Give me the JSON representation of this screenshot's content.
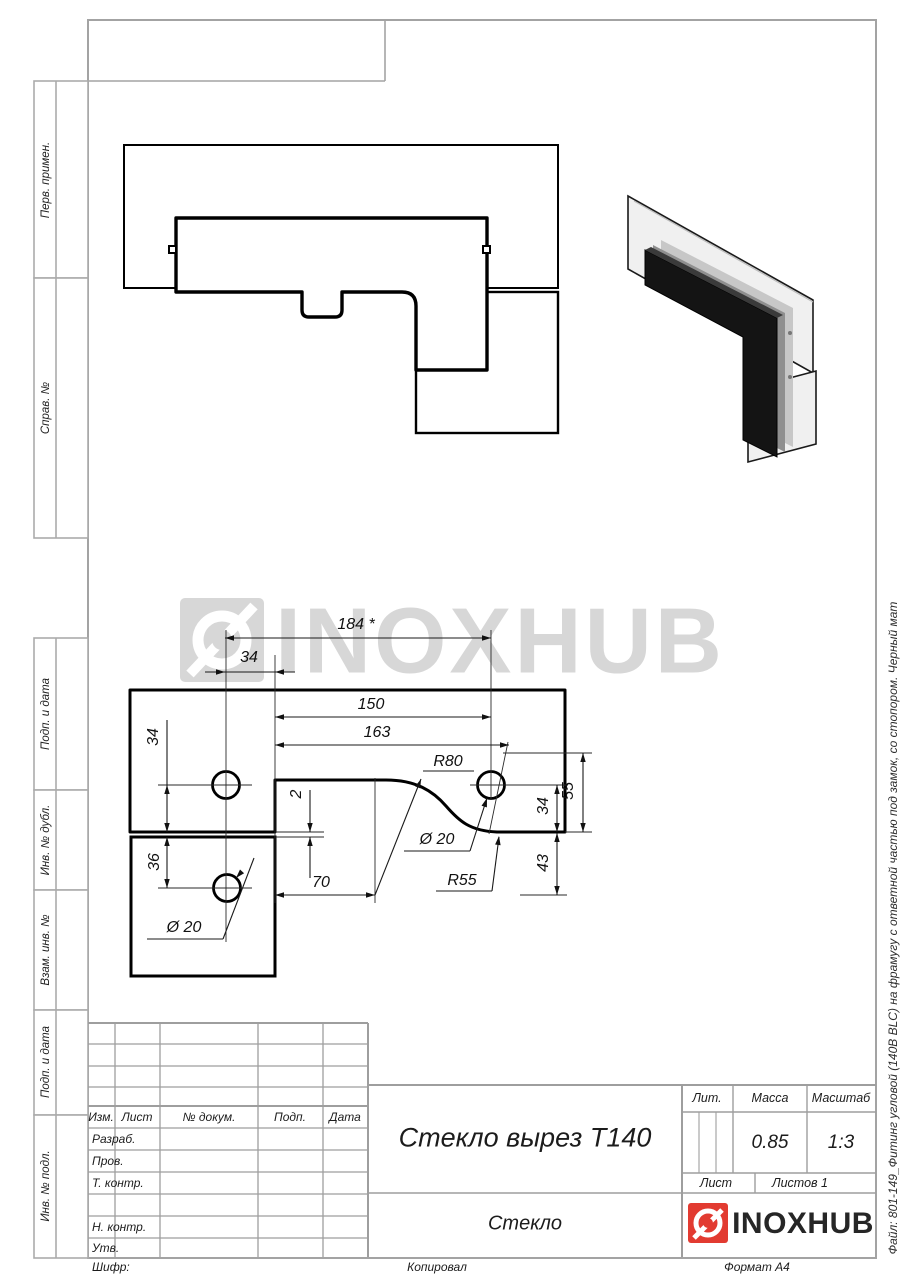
{
  "sheet": {
    "watermark_text": "INOXHUB",
    "file_note": "Файл: 801-149_Фитинг угловой (140В BLC) на фрамугу с ответной частью под замок, со стопором. Черный мат",
    "cipher_label": "Шифр:",
    "copied_note": "Копировал",
    "format_note": "Формат А4"
  },
  "margin_labels": {
    "perv": "Перв. примен.",
    "sprav": "Справ. №",
    "podp1": "Подп. и дата",
    "inv_dubl": "Инв. № дубл.",
    "vzam": "Взам. инв. №",
    "podp2": "Подп. и дата",
    "inv_podl": "Инв. № подл."
  },
  "title_block": {
    "doc_title": "Стекло вырез Т140",
    "part_name": "Стекло",
    "lit_label": "Лит.",
    "mass_label": "Масса",
    "scale_label": "Масштаб",
    "mass_value": "0.85",
    "scale_value": "1:3",
    "sheet_label": "Лист",
    "sheets_label": "Листов 1",
    "col_izm": "Изм.",
    "col_list": "Лист",
    "col_doc": "№ докум.",
    "col_podp": "Подп.",
    "col_data": "Дата",
    "row_razrab": "Разраб.",
    "row_prov": "Пров.",
    "row_tkontr": "Т. контр.",
    "row_nkontr": "Н. контр.",
    "row_utv": "Утв.",
    "logo_text": "INOXHUB"
  },
  "dimensions": {
    "len_184": "184 *",
    "off_34_top": "34",
    "len_150": "150",
    "len_163": "163",
    "rad_80": "R80",
    "gap_2": "2",
    "dia_20_top": "Ø 20",
    "off_34_left": "34",
    "h_55": "55",
    "off_34_right": "34",
    "h_43": "43",
    "off_36": "36",
    "len_70": "70",
    "rad_55": "R55",
    "dia_20_bottom": "Ø 20"
  }
}
